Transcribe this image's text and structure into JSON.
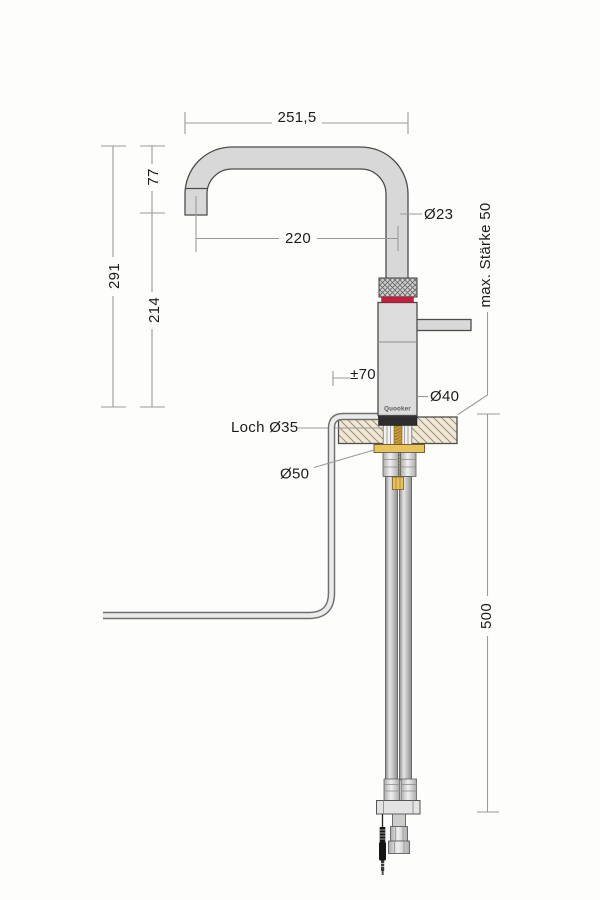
{
  "drawing": {
    "title": "Quooker tap installation drawing",
    "brand_label": "Quooker",
    "dims": {
      "top_width": "251,5",
      "reach": "220",
      "spout_drop": "77",
      "height_total": "291",
      "height_body": "214",
      "spout_diameter": "Ø23",
      "body_diameter": "Ø40",
      "hole_label": "Loch Ø35",
      "flange_diameter": "Ø50",
      "max_thickness": "max. Stärke 50",
      "under_counter_height": "500",
      "handle_range": "±70"
    },
    "colors": {
      "red_ring": "#c41f3c",
      "brass": "#e8c25d",
      "brass_rod": "#c79f3a",
      "counter_fill": "#f0e8d3",
      "gasket_black": "#2e2e2e",
      "cable_black": "#151515",
      "metal_fill": "#d8d8d8"
    }
  }
}
